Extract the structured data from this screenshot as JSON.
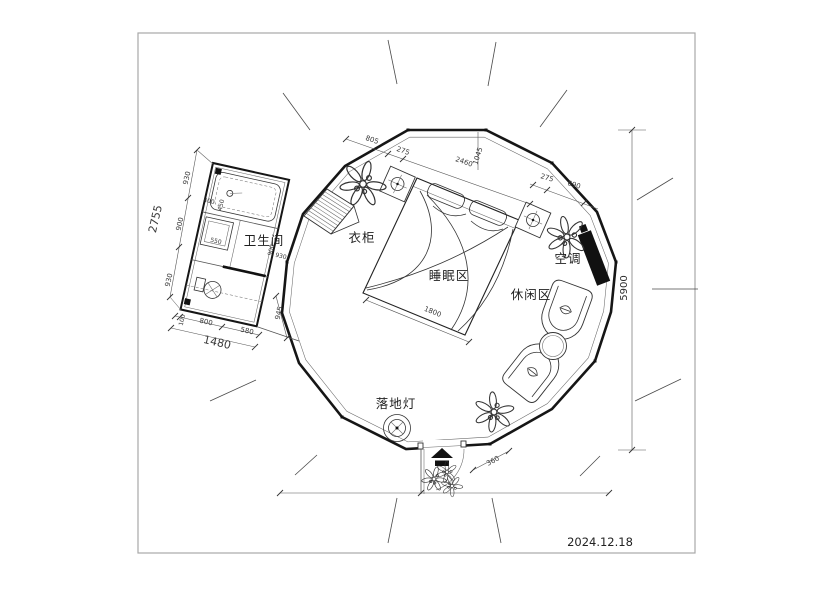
{
  "page": {
    "date": "2024.12.18"
  },
  "areas": {
    "bathroom": "卫生间",
    "wardrobe": "衣柜",
    "sleeping": "睡眠区",
    "leisure": "休闲区",
    "ac": "空调",
    "floor_lamp": "落地灯"
  },
  "dims": {
    "top_805": "805",
    "top_275": "275",
    "top_2460": "2460",
    "top_1045": "1045",
    "right_275": "275",
    "right_690": "690",
    "overall_5900": "5900",
    "bed_1800": "1800",
    "door_360": "360",
    "bath_total_2755": "2755",
    "bath_930_a": "930",
    "bath_900": "900",
    "bath_930_b": "930",
    "bath_total_1480": "1480",
    "bath_100": "100",
    "bath_800": "800",
    "bath_580": "580",
    "bath_945": "945",
    "bath_550": "550",
    "bath_in_900": "900",
    "bath_in_930": "930",
    "bath_400": "400",
    "bath_450": "450"
  },
  "colors": {
    "wall": "#161616",
    "line": "#4a4a4a",
    "dimension": "#555555",
    "text": "#2b2b2b",
    "background": "#ffffff",
    "border": "#a8a8a8",
    "solid_fill": "#111111"
  },
  "icons": [
    "plant-icon",
    "ceiling-lamp-icon",
    "floor-lamp-icon",
    "entrance-arrow-icon",
    "door-swing-icon",
    "bathtub-icon",
    "toilet-icon",
    "sink-icon",
    "wardrobe-hatch-icon",
    "ac-unit-icon",
    "armchair-icon",
    "side-table-icon"
  ]
}
